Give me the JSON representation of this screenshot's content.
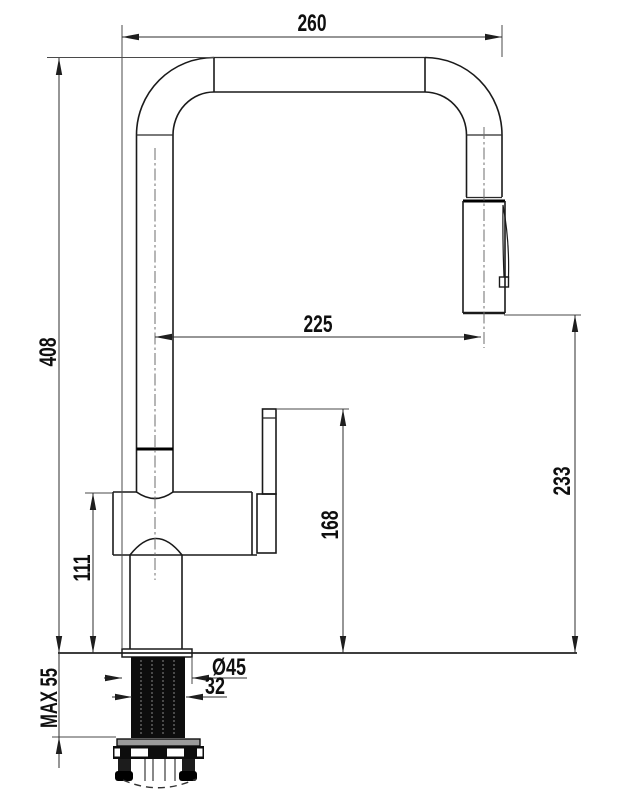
{
  "drawing": {
    "title": "Kitchen faucet dimensional drawing",
    "dims": {
      "spout_width": "260",
      "overall_height": "408",
      "spout_reach": "225",
      "outlet_height": "233",
      "handle_top_height": "168",
      "body_top_height": "111",
      "max_deck_thickness": "MAX 55",
      "flange_diameter": "Ø45",
      "shank_diameter": "32"
    }
  }
}
